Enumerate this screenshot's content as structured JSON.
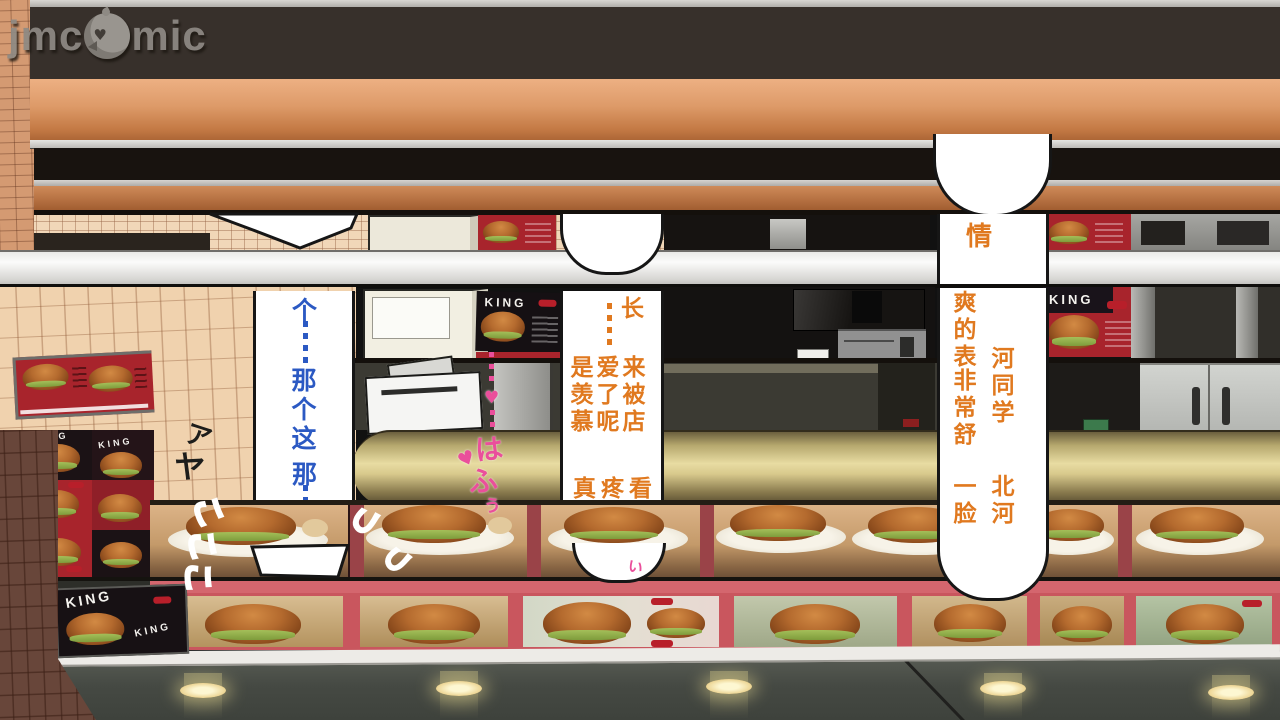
{
  "watermark": {
    "left": "jmc",
    "right": "mic",
    "bird_icon": "bird-mascot"
  },
  "bubbles": {
    "blue": {
      "top_char": "个",
      "middle": "那个这",
      "bottom": "那",
      "color": "#2b59c3"
    },
    "middle": {
      "col_a_top": "长",
      "col_a": "来被店",
      "col_b": "爱了呢",
      "col_c": "是羡慕",
      "row_b1": "真",
      "row_b2": "疼",
      "row_b3": "看",
      "color": "#e0791f"
    },
    "right": {
      "solo": "情",
      "col_l1": "爽的表",
      "col_l2": "非常舒",
      "col_l3": "一脸",
      "col_r1": "河同学",
      "col_r2": "北河",
      "color": "#e0791f"
    }
  },
  "sfx": {
    "black_1": "ア",
    "black_2": "ヤ",
    "white_1": "こ",
    "white_2": "こ",
    "white_3": "こ",
    "swoosh_1": "つ",
    "swoosh_2": "つ",
    "swoosh_3": "つ",
    "pink_1": "は",
    "pink_2": "ふ",
    "pink_3": "ぅ",
    "pink_small": "い",
    "heart_1": "♥",
    "heart_2": "♥"
  },
  "menus": {
    "king": "KING"
  },
  "colors": {
    "copper": "#c8824f",
    "menu_red": "#a8242c",
    "frame_pink": "#d4666e",
    "gold_band": "#d8c98c",
    "ceiling": "#474b43",
    "counter_white": "#efefec"
  }
}
